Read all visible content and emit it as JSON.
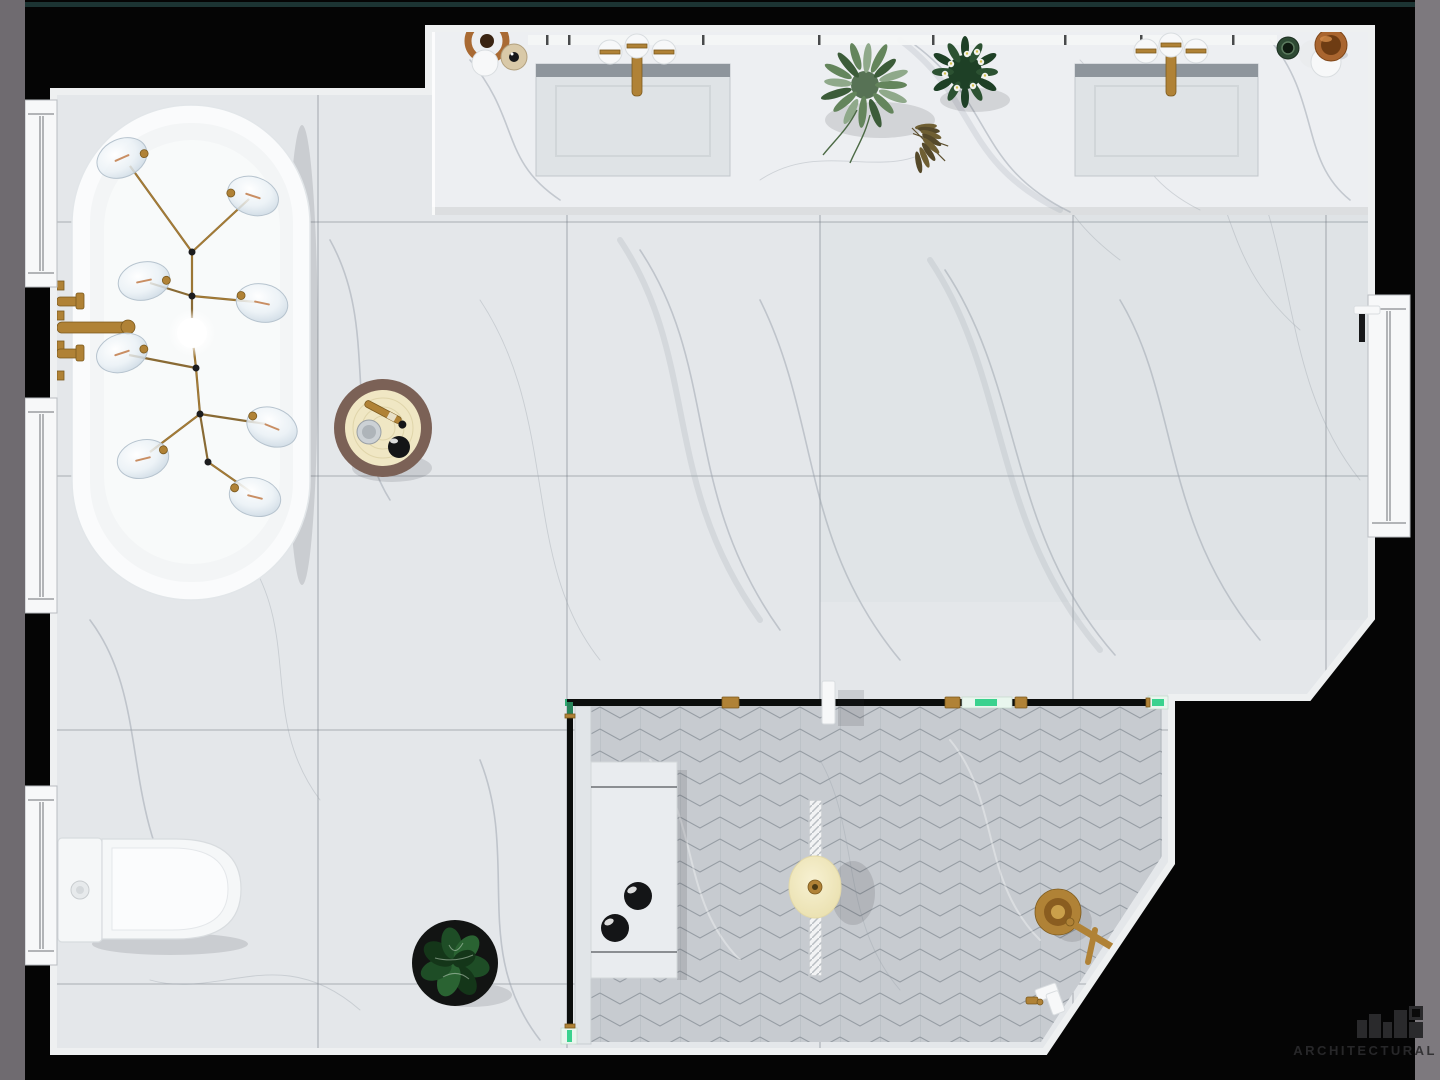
{
  "watermark": {
    "text": "ARCHITECTURAL"
  },
  "colors": {
    "bg": "#050505",
    "frame-left": "#6f6b70",
    "frame-right": "#7d797e",
    "topline": "#213d3c",
    "wall-edge": "#eef0f1",
    "floor": "#e4e7ea",
    "grout": "#6e757d",
    "vein": "#9aa2ac",
    "counter": "#edeff2",
    "sink-band": "#8e959c",
    "sink-basin": "#dfe3e6",
    "herr-base": "#c7cbd0",
    "herr-line": "#969da4",
    "brass": "#b08236",
    "brass-dark": "#7c5a1e",
    "glass-green": "#3ad28e",
    "glass-dark": "#0b0d0c",
    "tub": "#fafbfc",
    "tub-inner": "#f3f5f6",
    "white": "#f7f8f9",
    "table-rim": "#7b6156",
    "table-top": "#f0e7c4",
    "watermark": "#2b2b2d"
  },
  "scene": {
    "view": "top-down photorealistic render of a marble bathroom",
    "objects": [
      {
        "name": "bathtub",
        "label": "freestanding oval bathtub"
      },
      {
        "name": "chandelier",
        "label": "branching brass chandelier with eight glass globes"
      },
      {
        "name": "tub-filler",
        "label": "wall-mounted brass tub filler with two handles"
      },
      {
        "name": "side-table",
        "label": "round rattan-top side table with dish, candle and brush"
      },
      {
        "name": "vanity-counter",
        "label": "marble vanity counter with two undermount sinks"
      },
      {
        "name": "vanity-faucets",
        "label": "two brass wall faucets"
      },
      {
        "name": "vanity-lights",
        "label": "three globe lights above each sink"
      },
      {
        "name": "left-sconce",
        "label": "copper disc sconce with white globe"
      },
      {
        "name": "corner-decor",
        "label": "green jar, white globe lamp and copper bowl"
      },
      {
        "name": "plants-top",
        "label": "olive sprig, flowering plant and dried branch on counter"
      },
      {
        "name": "toilet",
        "label": "one-piece toilet on left wall"
      },
      {
        "name": "floor-plant",
        "label": "monstera in round black pot"
      },
      {
        "name": "shower",
        "label": "walk-in shower with herringbone tile floor"
      },
      {
        "name": "shower-glass",
        "label": "black-framed glass partition with brass clamps and white handle"
      },
      {
        "name": "shower-bench",
        "label": "marble shower bench with two black bottles"
      },
      {
        "name": "shower-light",
        "label": "linear hatched fixture with round cream diffuser"
      },
      {
        "name": "shower-valve",
        "label": "brass shower mixer with lever"
      },
      {
        "name": "hand-shower",
        "label": "hand shower set"
      },
      {
        "name": "windows",
        "label": "three casement windows on left wall, one on right wall"
      }
    ]
  }
}
